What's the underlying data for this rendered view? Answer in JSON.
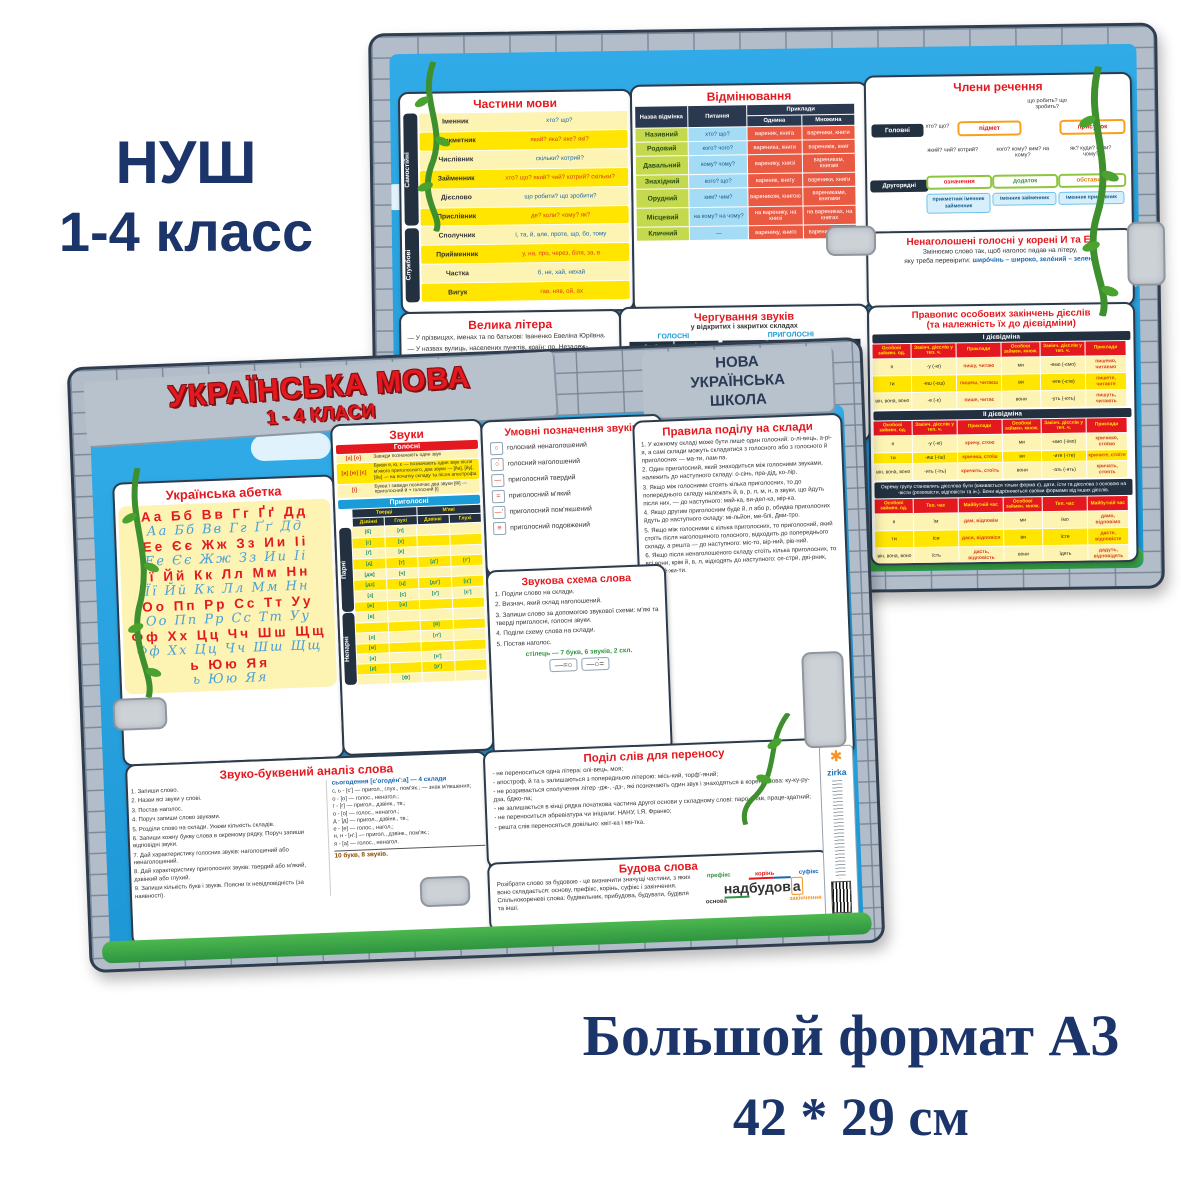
{
  "colors": {
    "accent_red": "#e4191f",
    "sky_blue": "#2aa7e4",
    "navy": "#1b3469",
    "yellow": "#ffe500",
    "brick_grey": "#b3bdc9"
  },
  "promo": {
    "top_line1": "НУШ",
    "top_line2": "1-4 класс",
    "bottom_line1": "Большой формат А3",
    "bottom_line2": "42 * 29 см"
  },
  "back": {
    "parts_of_speech": {
      "title": "Частини мови",
      "group_independent": "Самостійні",
      "group_service": "Службові",
      "rows": [
        [
          "Іменник",
          "хто? що?"
        ],
        [
          "Прикметник",
          "який? яка? яке? які?"
        ],
        [
          "Числівник",
          "скільки? котрий?"
        ],
        [
          "Займенник",
          "хто? що? який? чий? котрий? скільки?"
        ],
        [
          "Дієслово",
          "що робити? що зробити?"
        ],
        [
          "Прислівник",
          "де? коли? чому? як?"
        ],
        [
          "Сполучник",
          "і, та, й, але, проте, що, бо, тому"
        ],
        [
          "Прийменник",
          "у, на, про, через, біля, за, в"
        ],
        [
          "Частка",
          "б, не, хай, нехай"
        ],
        [
          "Вигук",
          "гав, няв, ой, ах"
        ]
      ]
    },
    "declension": {
      "title": "Відмінювання",
      "h_case": "Назва відмінка",
      "h_question": "Питання",
      "h_examples": "Приклади",
      "h_singular": "Однина",
      "h_plural": "Множина",
      "rows": [
        [
          "Називний",
          "хто? що?",
          "вареник, книга",
          "вареники, книги"
        ],
        [
          "Родовий",
          "кого? чого?",
          "вареника, книги",
          "вареників, книг"
        ],
        [
          "Давальний",
          "кому? чому?",
          "варенику, книзі",
          "вареникам, книгам"
        ],
        [
          "Знахідний",
          "кого? що?",
          "вареник, книгу",
          "вареники, книги"
        ],
        [
          "Орудний",
          "ким? чим?",
          "вареником, книгою",
          "варениками, книгами"
        ],
        [
          "Місцевий",
          "на кому? на чому?",
          "на варенику, на книзі",
          "на варениках, на книгах"
        ],
        [
          "Кличний",
          "—",
          "варенику, книго",
          "вареники, книги"
        ]
      ]
    },
    "members": {
      "title": "Члени речення",
      "main_label": "Головні",
      "secondary_label": "Другорядні",
      "main_q": "хто? що?",
      "predicate_q": "що робить? що зробить?",
      "subject": "підмет",
      "predicate": "присудок",
      "attr_q": "який? чий? котрий?",
      "obj_q": "кого? кому? ким? на кому?",
      "adv_q": "як? куди? коли? чому?",
      "attr": "означення",
      "obj": "додаток",
      "adv": "обставина",
      "attr_parts": "прикметник іменник займенник",
      "obj_parts": "іменник займенник",
      "adv_parts": "іменник прислівник"
    },
    "capital": {
      "title": "Велика літера",
      "items": [
        "— У прізвищах, іменах та по батькові: Іваненко Евеліна Юріївна.",
        "— У назвах вулиць, населених пунктів, країн: пр. Незалеж-"
      ]
    },
    "alternation": {
      "title": "Чергування звуків",
      "subtitle": "у відкритих і закритих складах",
      "vowels_label": "ГОЛОСНІ",
      "consonants_label": "ПРИГОЛОСНІ",
      "vowel_headers": [
        "-о-, -е-",
        "-і-"
      ],
      "vowel_rows": [
        [
          "джмеля",
          "джміль"
        ],
        [
          "ножі",
          "ніж"
        ]
      ],
      "cons_headers": [
        "г",
        "з",
        "ж"
      ],
      "cons_rows": [
        [
          "увага",
          "увазі",
          "уважний"
        ],
        [
          "луг",
          "у лузі",
          "лужок"
        ]
      ],
      "cons_headers2": [
        "к",
        "ц",
        "ч"
      ]
    },
    "unstressed": {
      "title": "Ненаголошені голосні у корені И та Е:",
      "line1": "Змінюємо слово так, щоб наголос падав на літеру,",
      "line2": "яку треба перевірити:",
      "examples": "ширóчінь – широко, зелéний – зелень"
    },
    "verbs": {
      "title1": "Правопис особових закінчень дієслів",
      "title2": "(та належність їх до дієвідміни)",
      "conj1": "І дієвідміна",
      "conj2": "ІІ дієвідміна",
      "headers": [
        "Особові займен. од.",
        "Закінч. дієслів у теп. ч.",
        "Приклади",
        "Особові займен. множ.",
        "Закінч. дієслів у теп. ч.",
        "Приклади"
      ],
      "rows1": [
        [
          "я",
          "-у (-ю)",
          "пишу, читаю",
          "ми",
          "-емо (-ємо)",
          "пишемо, читаємо"
        ],
        [
          "ти",
          "-еш (-єш)",
          "пишеш, читаєш",
          "ви",
          "-ете (-єте)",
          "пишете, читаєте"
        ],
        [
          "він, вона, воно",
          "-е (-є)",
          "пише, читає",
          "вони",
          "-уть (-ють)",
          "пишуть, читають"
        ]
      ],
      "rows2": [
        [
          "я",
          "-у (-ю)",
          "кричу, стою",
          "ми",
          "-имо (-їмо)",
          "кричимо, стоїмо"
        ],
        [
          "ти",
          "-иш (-їш)",
          "кричиш, стоїш",
          "ви",
          "-ите (-їте)",
          "кричите, стоїте"
        ],
        [
          "він, вона, воно",
          "-ить (-їть)",
          "кричить, стоїть",
          "вони",
          "-ать (-ять)",
          "кричать, стоять"
        ]
      ],
      "note": "Окрему групу становлять дієслова бути (вживається тільки форма є), дати, їсти та дієслова з основою на -вісти (розповісти, відповісти та ін.). Вони відрізняються своїми формами від інших дієслів.",
      "irr_headers": [
        "Особові займен. од.",
        "Теп. час",
        "Майбутній час",
        "Особові займен. множ.",
        "Теп. час",
        "Майбутній час"
      ],
      "irr_rows": [
        [
          "я",
          "їм",
          "дам, відповім",
          "ми",
          "їмо",
          "дамо, відповімо"
        ],
        [
          "ти",
          "їси",
          "даси, відповіси",
          "ви",
          "їсте",
          "дасте, відповісте"
        ],
        [
          "він, вона, воно",
          "їсть",
          "дасть, відповість",
          "вони",
          "їдять",
          "дадуть, відповідять"
        ]
      ]
    }
  },
  "front": {
    "title": "УКРАЇНСЬКА МОВА",
    "subtitle": "1 - 4 КЛАСИ",
    "badge_line1": "НОВА",
    "badge_line2": "УКРАЇНСЬКА",
    "badge_line3": "ШКОЛА",
    "alphabet": {
      "title": "Українська абетка",
      "rows": [
        {
          "p": "Аа Бб Вв Гг Ґґ Дд",
          "c": "Аа Бб Вв Гг Ґґ Дд"
        },
        {
          "p": "Ее Єє Жж Зз Ии Іі",
          "c": "Ее Єє Жж Зз Ии Іі"
        },
        {
          "p": "Її Йй Кк Лл Мм Нн",
          "c": "Її Йй Кк Лл Мм Нн"
        },
        {
          "p": "Оо Пп Рр Сс Тт Уу",
          "c": "Оо Пп Рр Сс Тт Уу"
        },
        {
          "p": "Фф Хх Цц Чч Шш Щщ",
          "c": "Фф Хх Цц Чч Шш Щщ"
        },
        {
          "p": "ь Юю Яя",
          "c": "ь Юю Яя"
        }
      ]
    },
    "sounds": {
      "title": "Звуки",
      "vowels_label": "Голосні",
      "vowel_rows": [
        {
          "sym": "[а] [о]",
          "text": "Завжди позначають один звук"
        },
        {
          "sym": "[я] [ю] [є]",
          "text": "Букви я, ю, є — позначають один звук після м'якого приголосного, два звуки — [йа], [йу], [йе] — на початку складу та після апострофа"
        },
        {
          "sym": "[ї]",
          "text": "Буква ї завжди позначає два звуки [йі] — приголосний й + голосний [і]"
        }
      ],
      "consonants_label": "Приголосні",
      "hard_label": "Тверді",
      "soft_label": "М'які",
      "voiced_label": "Дзвінкі",
      "voiceless_label": "Глухі",
      "paired_label": "Парні",
      "unpaired_label": "Непарні",
      "paired_rows": [
        [
          "[б]",
          "[п]",
          "",
          ""
        ],
        [
          "[г]",
          "[х]",
          "",
          ""
        ],
        [
          "[ґ]",
          "[к]",
          "",
          ""
        ],
        [
          "[д]",
          "[т]",
          "[д′]",
          "[т′]"
        ],
        [
          "[дж]",
          "[ч]",
          "",
          ""
        ],
        [
          "[дз]",
          "[ц]",
          "[дз′]",
          "[ц′]"
        ],
        [
          "[з]",
          "[с]",
          "[з′]",
          "[с′]"
        ],
        [
          "[ж]",
          "[ш]",
          "",
          ""
        ]
      ],
      "unpaired_rows": [
        [
          "[в]",
          "",
          "",
          ""
        ],
        [
          "",
          "",
          "[й]",
          ""
        ],
        [
          "[л]",
          "",
          "[л′]",
          ""
        ],
        [
          "[м]",
          "",
          "",
          ""
        ],
        [
          "[н]",
          "",
          "[н′]",
          ""
        ],
        [
          "[р]",
          "",
          "[р′]",
          ""
        ],
        [
          "",
          "[ф]",
          "",
          ""
        ]
      ]
    },
    "symbols": {
      "title": "Умовні позначення звуків",
      "items": [
        {
          "sym": "○",
          "label": "голосний ненаголошений"
        },
        {
          "sym": "○́",
          "label": "голосний наголошений"
        },
        {
          "sym": "—",
          "label": "приголосний твердий"
        },
        {
          "sym": "=",
          "label": "приголосний м'який"
        },
        {
          "sym": "—’",
          "label": "приголосний пом'якшений"
        },
        {
          "sym": "≡",
          "label": "приголосний подовжений"
        }
      ]
    },
    "rules": {
      "title": "Правила поділу на склади",
      "items": [
        "1. У кожному складі може бути лише один голосний: о-лі-вець, а-рі-я, а самі склади можуть складатися з голосного або з голосного й приголосних — ма-ти, лам-па.",
        "2. Один приголосний, який знаходиться між голосними звуками, належить до наступного складу: о-сінь, пра-дід, ко-лір.",
        "3. Якщо між голосними стоять кілька приголосних, то до попереднього складу належать й, в, р, л, м, н, а звуки, що йдуть після них, — до наступного: май-ка, ви-дел-ка, мір-ка.",
        "4. Якщо другим приголосним буде й, л або р, обидва приголосних йдуть до наступного складу: мі-льйон, ме-блі, Дми-тро.",
        "5. Якщо між голосними є кілька приголосних, то приголосний, який стоїть після наголошеного голосного, відходить до попереднього складу, а решта — до наступного: міс-то, вір-ний, рів-ний.",
        "6. Якщо після ненаголошеного складу стоїть кілька приголосних, то всі вони, крім й, в, л, відходять до наступного: се-стри́, дві-рник, про-сте́-жи-ти."
      ]
    },
    "scheme": {
      "title": "Звукова схема слова",
      "steps": [
        "1. Поділи слово на склади.",
        "2. Визнач, який склад наголошений.",
        "3. Запиши слово за допомогою звукової схеми: м'які та тверді приголосні, голосні звуки.",
        "4. Поділи схему слова на склади.",
        "5. Постав наголос."
      ],
      "example": "стілець — 7 букв, 6 звуків, 2 скл.",
      "box1": "—=○",
      "box2": "—○́="
    },
    "analysis": {
      "title": "Звуко-буквений аналіз слова",
      "steps": [
        "1. Запиши слово.",
        "2. Назви всі звуки у слові.",
        "3. Постав наголос.",
        "4. Поруч запиши слово звуками.",
        "5. Розділи слово на склади. Укажи кількість складів.",
        "6. Запиши кожну букву слова в окремому рядку. Поруч запиши відповідні звуки.",
        "7. Дай характеристику голосних звуків: наголошений або ненаголошений.",
        "8. Дай характеристику приголосних звуків: твердий або м'який, дзвінкий або глухий.",
        "9. Запиши кількість букв і звуків. Поясни їх невідповідність (за наявності)."
      ],
      "example_title": "сьогодення [с'огоде́н':а] — 4 склади",
      "lines": [
        "с, ь - [с'] — пригол., глух., пом'як.; — знак м'якшення;",
        "о - [о] — голос., ненагол.;",
        "г - [г] — пригол., дзвінк., тв.;",
        "о - [о] — голос., ненагол.;",
        "д - [д] — пригол., дзвінк., тв.;",
        "е - [е] — голос., нагол.;",
        "н, н - [н':] — пригол., дзвінк., пом'як.;",
        "я - [а] — голос., ненагол."
      ],
      "total": "10 букв, 8 звуків."
    },
    "transfer": {
      "title": "Поділ слів для переносу",
      "items": [
        "- не переноситься одна літера: олі-вець, моя;",
        "- апостроф, й та ь залишаються з попередньою літерою: місь-кий, торф'-яний;",
        "- не розривається сполучення літер -дж-, -дз-, які позначають один звук і знаходяться в корені слова: ку-ку-ру-дза, бджо-ла;",
        "- не залишається в кінці рядка початкова частина другої основи у складному слові: паро-плав, праце-здатний;",
        "- не переноситься абревіатура чи ініціали: НАНУ, І.Я. Франко;",
        "- решта слів переносяться довільно: квіт-ка і кві-тка."
      ]
    },
    "structure": {
      "title": "Будова слова",
      "text": "Розібрати слово за будовою - це визначити значущі частини, з яких воно складається: основу, префікс, корінь, суфікс і закінчення. Спільнокореневі слова: будівельник, прибудова, будувати, будівля та інші.",
      "labels": {
        "prefix": "префікс",
        "root": "корінь",
        "suffix": "суфікс",
        "base": "основа",
        "ending": "закінчення"
      },
      "word_parts": {
        "prefix": "над",
        "root": "буд",
        "suffix": "ов",
        "ending": "а"
      }
    },
    "brand": {
      "name": "zirka"
    }
  }
}
